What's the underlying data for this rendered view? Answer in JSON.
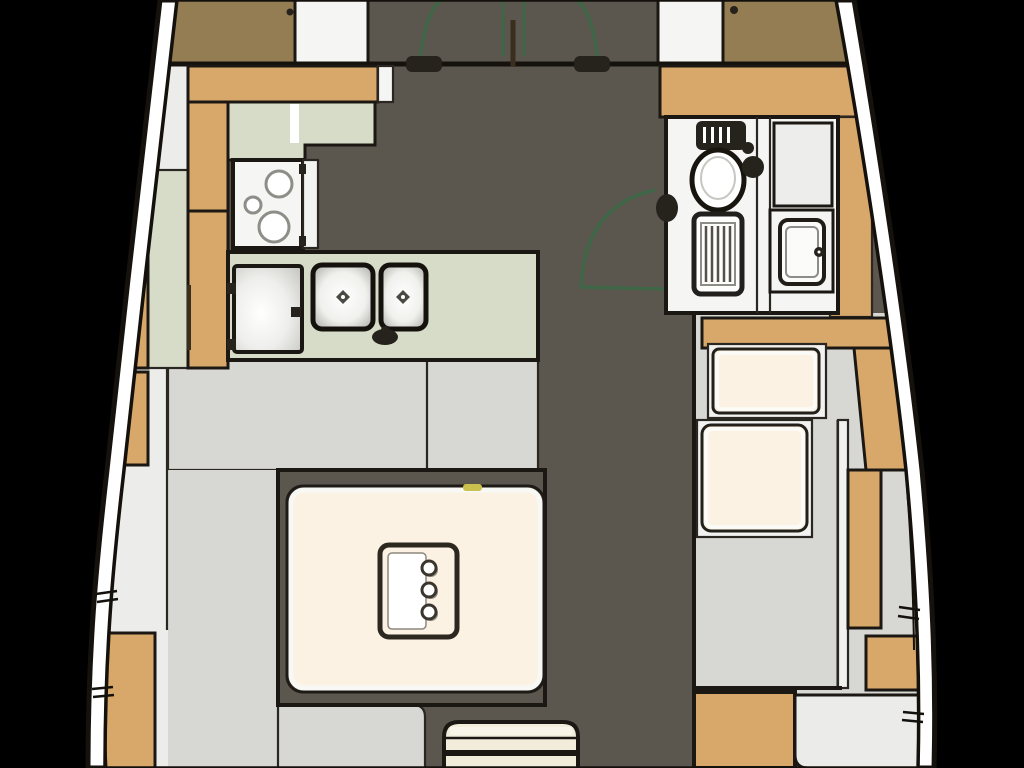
{
  "meta": {
    "title": "Sailboat interior floor plan - main saloon section",
    "diagram_type": "boat-interior-floorplan",
    "visible_text": "none"
  },
  "colors": {
    "background": "#000000",
    "hull_band": "#ffffff",
    "hull_edge": "#0b0a08",
    "inner_line": "#14110d",
    "floor_dark": "#5b564e",
    "floor_light": "#d7d7d3",
    "shelf_light": "#ececea",
    "wood_tan": "#d8a86a",
    "wood_dark": "#957d53",
    "counter_green": "#d6dcc8",
    "fixture_white": "#f5f5f3",
    "cushion_cream": "#fcf2e4",
    "stripe_cream": "#f2ecda",
    "door_green": "#3e6647",
    "hinge_dark": "#26221c",
    "accent_yellow": "#c9c04e",
    "corner_light": "#ebebe9"
  },
  "areas": {
    "forward_bulkhead": {
      "name": "forward-cabin-double-door",
      "features": [
        "left-door-swing-arc",
        "right-door-swing-arc",
        "door-hinges",
        "center-post"
      ]
    },
    "galley": {
      "name": "galley",
      "fixtures": [
        "l-shaped-counter",
        "three-burner-stove",
        "refrigerator",
        "double-sink",
        "faucet"
      ]
    },
    "saloon": {
      "name": "saloon",
      "fixtures": [
        "dinette-table",
        "table-inset-bottle-holder",
        "bench-platform",
        "striped-stool-seat"
      ]
    },
    "head": {
      "name": "head-compartment",
      "fixtures": [
        "marine-toilet",
        "shower-grate",
        "washbasin",
        "storage-cabinet",
        "door-swing-arc"
      ]
    },
    "nav_station": {
      "name": "nav-station",
      "fixtures": [
        "seat-cushion",
        "chart-table",
        "stowage-panels"
      ]
    }
  }
}
